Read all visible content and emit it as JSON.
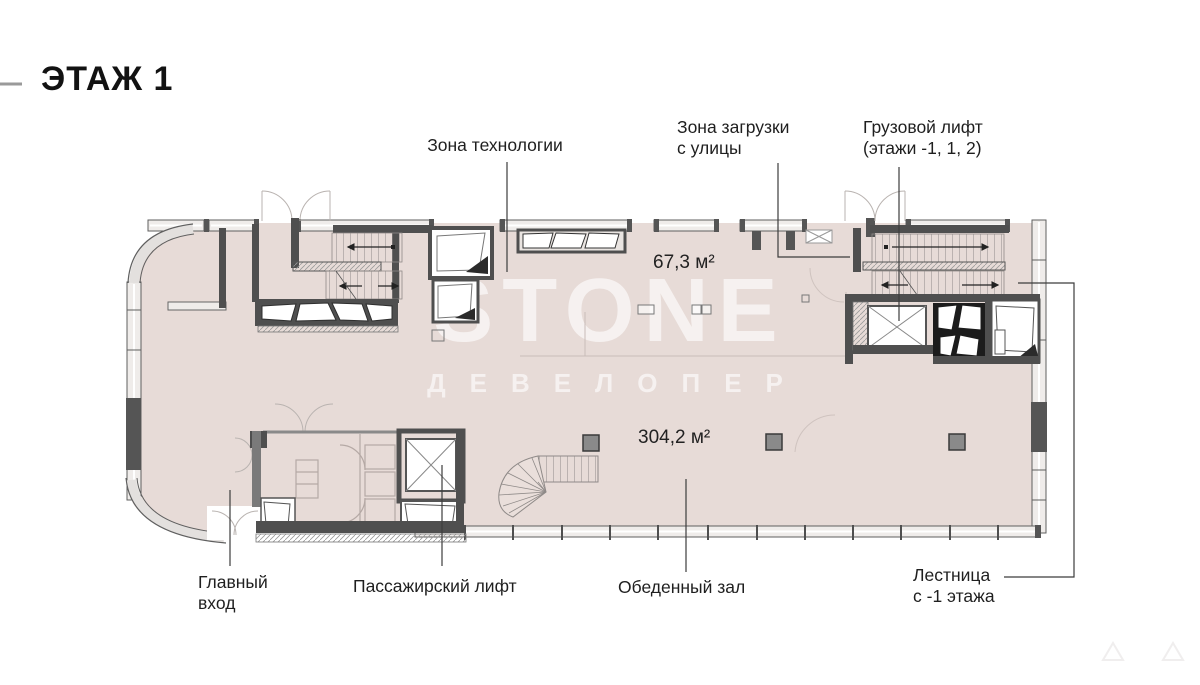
{
  "header": {
    "title": "ЭТАЖ 1"
  },
  "watermark": {
    "brand": "STONE",
    "subtitle": "ДЕВЕЛОПЕР"
  },
  "plan": {
    "areas": {
      "loading_zone_area": "67,3 м²",
      "dining_hall_area": "304,2 м²"
    },
    "labels": {
      "technology_zone": "Зона технологии",
      "loading_zone": "Зона загрузки\nс улицы",
      "freight_elevator": "Грузовой лифт\n(этажи -1, 1, 2)",
      "main_entrance": "Главный\nвход",
      "passenger_elevator": "Пассажирский лифт",
      "dining_hall": "Обеденный зал",
      "stairs_from_minus1": "Лестница\nс -1 этажа"
    },
    "colors": {
      "floor": "#e7dbd7",
      "wall": "#4f4f4f",
      "text": "#1f1f1f",
      "watermark": "rgba(255,255,255,0.62)"
    }
  }
}
